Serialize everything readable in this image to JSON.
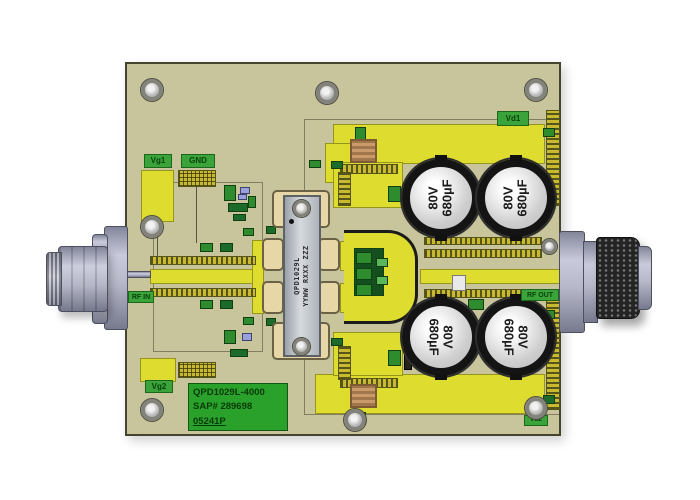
{
  "colors": {
    "canvas-bg": "#ffffff",
    "board": "#c8c59c",
    "copper-bright": "#dddc2f",
    "copper-gold": "#c9b931",
    "silk-green": "#3aa33a",
    "silk-text": "#0a430a",
    "label-green": "#2aa12a",
    "cap-rim": "#141414",
    "pkg-flange": "#e7d7a7"
  },
  "board": {
    "silkscreen": {
      "vg1": "Vg1",
      "gnd": "GND",
      "vd1": "Vd1",
      "rf_in": "RF IN",
      "rf_out": "RF OUT",
      "vg2": "Vg2",
      "vd2": "Vd2"
    },
    "id_label": {
      "line1": "QPD1029L-4000",
      "line2": "SAP# 289698",
      "line3": "05241P"
    },
    "transistor_marking": {
      "line1": "QPD1029L",
      "line2": "YYWW RXXX ZZZ"
    },
    "capacitors": [
      {
        "voltage": "80V",
        "capacitance": "680µF"
      },
      {
        "voltage": "80V",
        "capacitance": "680µF"
      },
      {
        "voltage": "80V",
        "capacitance": "680µF"
      },
      {
        "voltage": "80V",
        "capacitance": "680µF"
      }
    ]
  }
}
